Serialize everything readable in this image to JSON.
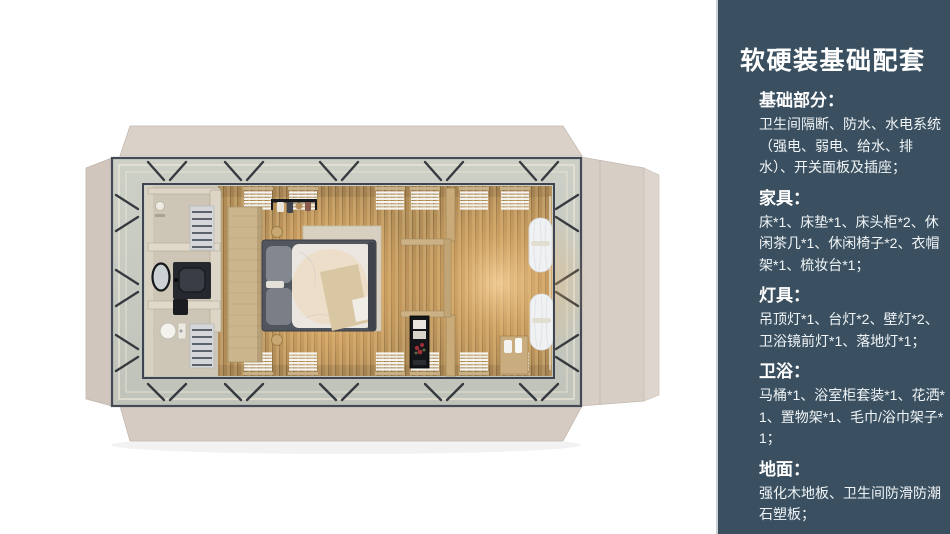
{
  "panel": {
    "title": "软硬装基础配套",
    "sections": [
      {
        "heading": "基础部分：",
        "body": "卫生间隔断、防水、水电系统（强电、弱电、给水、排水）、开关面板及插座；"
      },
      {
        "heading": "家具：",
        "body": "床*1、床垫*1、床头柜*2、休闲茶几*1、休闲椅子*2、衣帽架*1、梳妆台*1；"
      },
      {
        "heading": "灯具：",
        "body": "吊顶灯*1、台灯*2、壁灯*2、卫浴镜前灯*1、落地灯*1；"
      },
      {
        "heading": "卫浴：",
        "body": "马桶*1、浴室柜套装*1、花洒*1、置物架*1、毛巾/浴巾架子*1；"
      },
      {
        "heading": "地面：",
        "body": "强化木地板、卫生间防滑防潮石塑板；"
      }
    ]
  },
  "colors": {
    "panel_bg": "#3a5060",
    "panel_border": "#cdd1d3",
    "panel_text": "#ffffff",
    "flap_beige": "#d8cfc7",
    "deck_gray": "#c6c9c0",
    "steel_frame": "#3f4550",
    "wood_floor": "#bf9e68",
    "warm_glow": "#f0b469",
    "bathroom_floor": "#cdc5b5",
    "bed_duvet": "#ebe7e0",
    "curtain_white": "#eff1f3"
  }
}
